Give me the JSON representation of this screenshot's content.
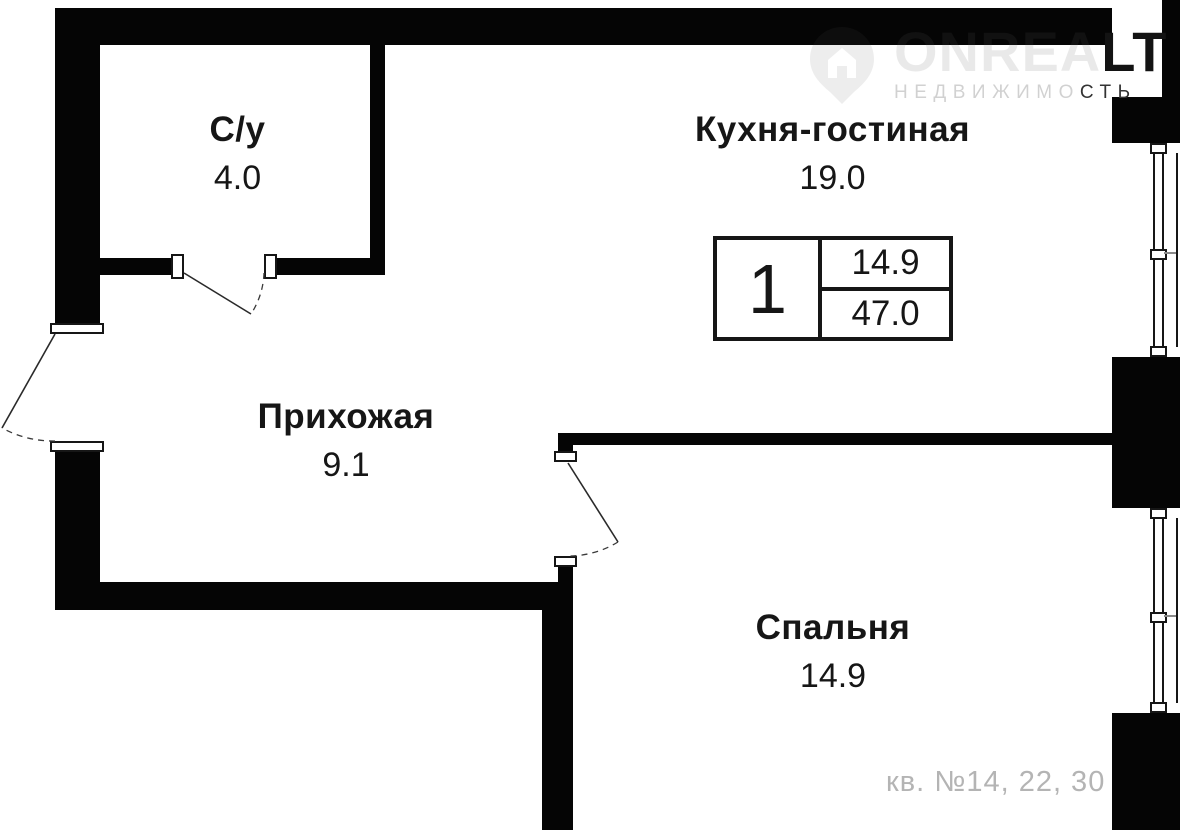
{
  "logo": {
    "brand_light": "ONREA",
    "brand_dark": "LT",
    "tagline_light": "НЕДВИЖИМО",
    "tagline_dark": "СТЬ"
  },
  "rooms": {
    "bathroom": {
      "name": "С/у",
      "area": "4.0"
    },
    "kitchen_living": {
      "name": "Кухня-гостиная",
      "area": "19.0"
    },
    "hallway": {
      "name": "Прихожая",
      "area": "9.1"
    },
    "bedroom": {
      "name": "Спальня",
      "area": "14.9"
    }
  },
  "info_box": {
    "rooms_count": "1",
    "living_area": "14.9",
    "total_area": "47.0"
  },
  "footer_note": "кв. №14, 22, 30",
  "colors": {
    "wall": "#050505",
    "text": "#161616",
    "muted_text": "#b4b4b4"
  }
}
